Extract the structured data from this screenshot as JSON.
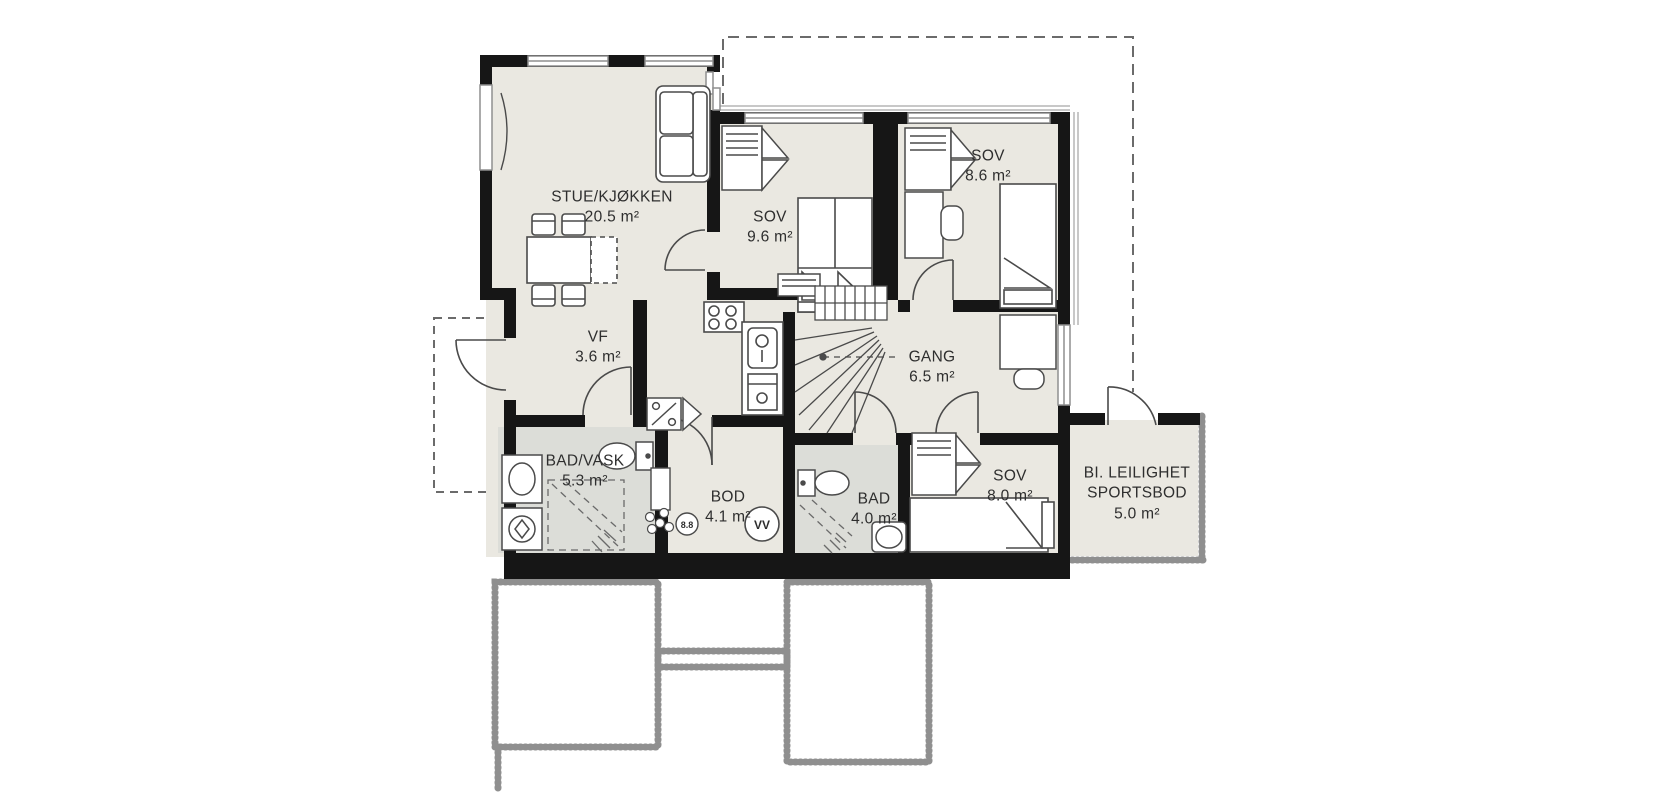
{
  "plan": {
    "kind": "apartment floor plan",
    "language": "Norwegian"
  },
  "rooms": [
    {
      "name": "STUE/KJØKKEN",
      "area": "20.5 m²"
    },
    {
      "name": "SOV",
      "area": "9.6 m²"
    },
    {
      "name": "SOV",
      "area": "8.6 m²"
    },
    {
      "name": "VF",
      "area": "3.6 m²"
    },
    {
      "name": "GANG",
      "area": "6.5 m²"
    },
    {
      "name": "BAD/VASK",
      "area": "5.3 m²"
    },
    {
      "name": "BOD",
      "area": "4.1 m²"
    },
    {
      "name": "BAD",
      "area": "4.0 m²"
    },
    {
      "name": "SOV",
      "area": "8.0 m²"
    },
    {
      "name": "BI. LEILIGHET",
      "name2": "SPORTSBOD",
      "area": "5.0 m²"
    }
  ],
  "fixtures": {
    "water_heater": "VV",
    "drain": "8.8"
  },
  "colors": {
    "wall": "#161616",
    "floor": "#eae8e1",
    "wet_room_floor": "#dcddd8",
    "outline_dashed": "#6b6b6b",
    "foundation": "#8f8f8f",
    "furniture_line": "#4a4a4a"
  }
}
